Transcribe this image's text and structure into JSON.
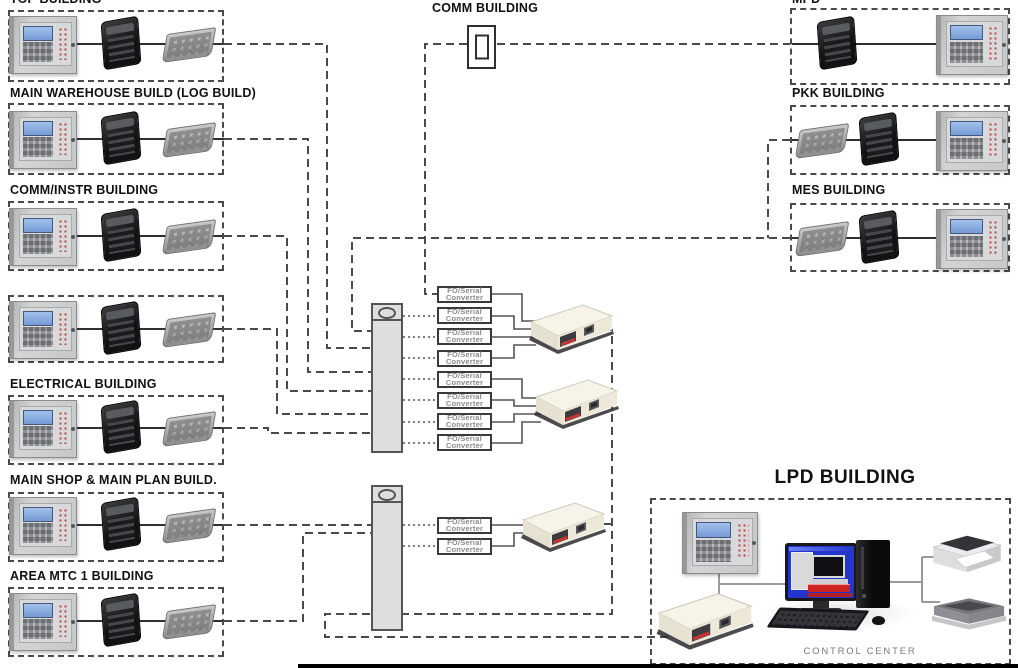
{
  "diagram": {
    "left_buildings": [
      {
        "label": "TOP BUILDING"
      },
      {
        "label": "MAIN WAREHOUSE BUILD (LOG BUILD)"
      },
      {
        "label": "COMM/INSTR BUILDING"
      },
      {
        "label": ""
      },
      {
        "label": "ELECTRICAL BUILDING"
      },
      {
        "label": "MAIN SHOP & MAIN PLAN BUILD."
      },
      {
        "label": "AREA MTC 1 BUILDING"
      }
    ],
    "top_building": {
      "label": "COMM BUILDING"
    },
    "right_buildings": [
      {
        "label": "MPD"
      },
      {
        "label": "PKK BUILDING"
      },
      {
        "label": "MES BUILDING"
      }
    ],
    "converter_label": {
      "line1": "FO/Serial",
      "line2": "Converter"
    },
    "converter_counts": {
      "upper_bank": 8,
      "lower_bank": 2
    },
    "lpd_building": {
      "label": "LPD BUILDING",
      "control_center": "CONTROL CENTER"
    },
    "colors": {
      "line": "#4a4a4a",
      "lcd_blue": "#7b9fd8",
      "led_red": "#c24444",
      "screen_blue": "#2335cc"
    }
  }
}
